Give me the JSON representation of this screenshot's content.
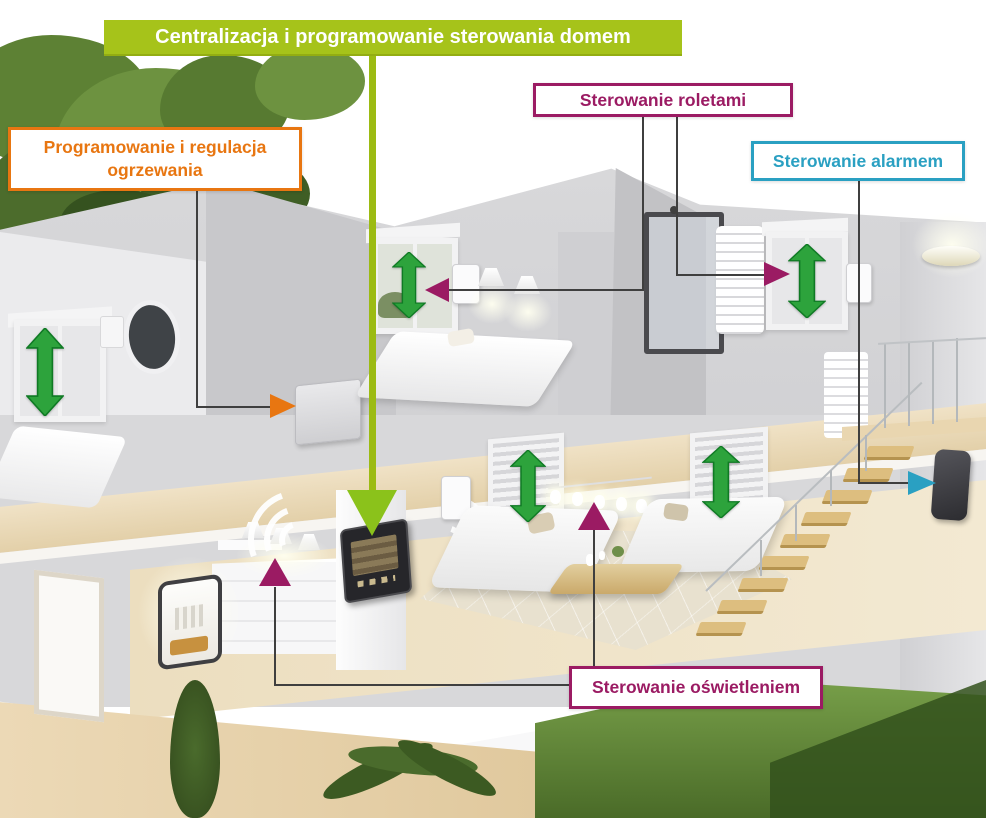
{
  "banner": {
    "label": "Centralizacja i programowanie sterowania domem",
    "bg_color": "#a6c31a",
    "text_color": "#ffffff"
  },
  "callouts": {
    "heating": {
      "label": "Programowanie i regulacja ogrzewania",
      "accent": "#e87611"
    },
    "shutters": {
      "label": "Sterowanie roletami",
      "accent": "#9b1b63"
    },
    "alarm": {
      "label": "Sterowanie alarmem",
      "accent": "#2aa0c2"
    },
    "lighting": {
      "label": "Sterowanie oświetleniem",
      "accent": "#9b1b63"
    }
  },
  "annotations": {
    "central_arrow": {
      "icon": "big-down-arrow-icon",
      "color": "#8bc21b",
      "target": "touchscreen-control-panel"
    },
    "wifi_waves": {
      "icon": "wifi-waves-icon",
      "color": "#ffffff",
      "count": 2
    },
    "shutter_arrows": {
      "icon": "double-vertical-arrow-icon",
      "color": "#2da33c",
      "count": 5
    },
    "shutter_pointers": {
      "icon": "pointer-triangle-icon",
      "color": "#9b1b63",
      "count": 2
    },
    "lighting_pointers": {
      "icon": "pointer-up-triangle-icon",
      "color": "#9b1b63",
      "count": 2
    },
    "heating_pointer": {
      "icon": "pointer-right-triangle-icon",
      "color": "#e87611",
      "count": 1
    },
    "alarm_pointer": {
      "icon": "pointer-right-triangle-icon",
      "color": "#2aa0c2",
      "count": 1
    }
  }
}
